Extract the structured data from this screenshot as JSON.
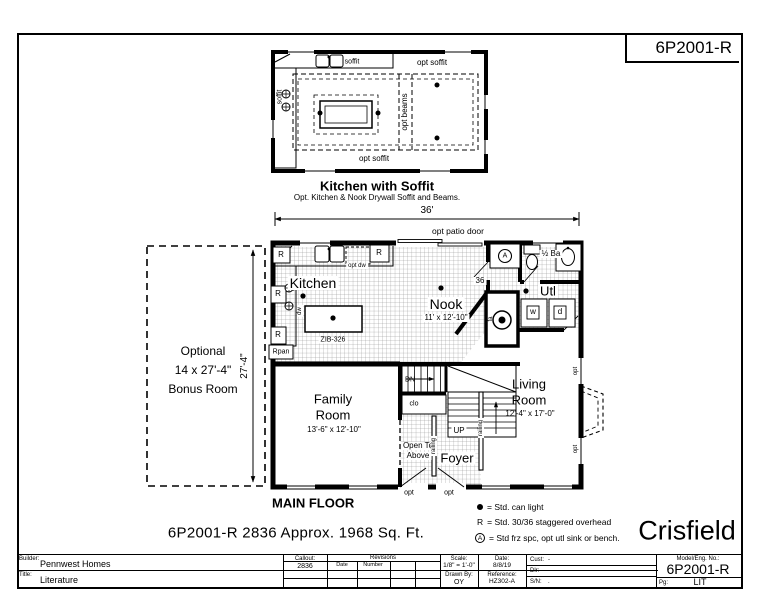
{
  "sheet": {
    "drawing_number": "6P2001-R",
    "model_name": "Crisfield",
    "caption": "6P2001-R 2836  Approx. 1968 Sq. Ft.",
    "main_floor_label": "MAIN FLOOR"
  },
  "inset": {
    "title": "Kitchen with Soffit",
    "subtitle": "Opt. Kitchen & Nook Drywall Soffit and Beams.",
    "opt_soffit": "opt soffit",
    "soffit": "soffit",
    "opt_beams": "opt beams"
  },
  "plan": {
    "width_dim": "36'",
    "height_dim": "27'-4\"",
    "opt_patio_door": "opt patio door",
    "kitchen": "Kitchen",
    "nook": "Nook",
    "nook_dim": "11' x 12'-10\"",
    "utility": "Utl",
    "half_bath": "½ Ba",
    "family_room_1": "Family",
    "family_room_2": "Room",
    "family_dim": "13'-6\" x 12'-10\"",
    "living_room_1": "Living",
    "living_room_2": "Room",
    "living_dim": "12'-4\" x 17'-0\"",
    "foyer": "Foyer",
    "open_to_above_1": "Open To",
    "open_to_above_2": "Above",
    "closet": "clo",
    "up": "UP",
    "dn": "DN",
    "railing": "railing",
    "island_model": "ZIB-326",
    "opt_dw": "opt dw",
    "dw": "dw",
    "r_marker": "R",
    "rpan": "Rpan",
    "washer": "w",
    "dryer": "d",
    "furnace": "fa",
    "frz_symbol": "A",
    "wall_36": "36",
    "opt": "opt",
    "bonus_1": "Optional",
    "bonus_2": "14 x 27'-4\"",
    "bonus_3": "Bonus Room"
  },
  "legend": {
    "can_light_text": "= Std. can light",
    "r_sym": "R",
    "r_text": "= Std. 30/36 staggered overhead",
    "a_sym": "A",
    "a_text": "= Std frz spc, opt utl sink or bench."
  },
  "title_block": {
    "builder_label": "Builder:",
    "builder": "Pennwest Homes",
    "title_label": "Title:",
    "title": "Literature",
    "callout_label": "Callout:",
    "callout": "2836",
    "revisions_label": "Revisions",
    "rev_date_label": "Date",
    "rev_number_label": "Number",
    "scale_label": "Scale:",
    "scale": "1/8\" = 1'-0\"",
    "date_label": "Date:",
    "date": "8/8/19",
    "drawn_by_label": "Drawn By:",
    "drawn_by": "OY",
    "reference_label": "Reference:",
    "reference": "HZ302-A",
    "cust_label": "Cust:",
    "cust": "-",
    "dlr_label": "Dlr:",
    "dlr": "-",
    "sn_label": "S/N:",
    "sn": ".",
    "model_label": "Model/Eng. No.:",
    "model": "6P2001-R",
    "pg_label": "Pg:",
    "pg": "LIT"
  }
}
